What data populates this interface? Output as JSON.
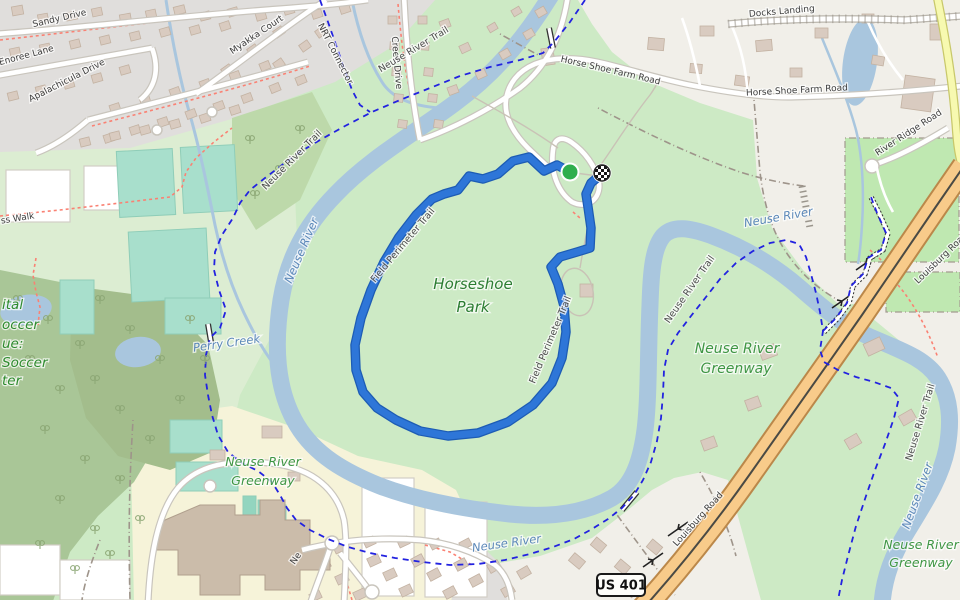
{
  "map": {
    "type": "openstreetmap-with-gps-activity",
    "colors": {
      "park_green": "#cdeac5",
      "grass_green": "#bfe8b1",
      "forest_green": "#a9c697",
      "residential_gray": "#e0dedc",
      "land_beige": "#f1efe9",
      "school_yellow": "#f6f3d9",
      "pitch_teal": "#a8dfcc",
      "water": "#a9c6de",
      "primary_road": "#f8cb8a",
      "secondary_road": "#f7f9b0",
      "cycleway_dash": "#2222e0",
      "footway_dash": "#fa8173",
      "gps_route": "#2e76d8",
      "start_marker": "#2fae4d"
    },
    "route": {
      "name": "gps-activity-route",
      "color": "#2e76d8",
      "outline": "#1d5cb4",
      "points": [
        [
          570,
          172
        ],
        [
          557,
          165
        ],
        [
          544,
          171
        ],
        [
          529,
          157
        ],
        [
          513,
          161
        ],
        [
          498,
          174
        ],
        [
          483,
          179
        ],
        [
          469,
          176
        ],
        [
          458,
          190
        ],
        [
          444,
          194
        ],
        [
          432,
          199
        ],
        [
          416,
          215
        ],
        [
          399,
          237
        ],
        [
          384,
          262
        ],
        [
          371,
          290
        ],
        [
          361,
          318
        ],
        [
          355,
          345
        ],
        [
          356,
          370
        ],
        [
          363,
          392
        ],
        [
          377,
          408
        ],
        [
          396,
          420
        ],
        [
          420,
          431
        ],
        [
          448,
          436
        ],
        [
          478,
          433
        ],
        [
          508,
          422
        ],
        [
          533,
          405
        ],
        [
          552,
          383
        ],
        [
          562,
          358
        ],
        [
          566,
          332
        ],
        [
          564,
          306
        ],
        [
          558,
          284
        ],
        [
          551,
          267
        ],
        [
          560,
          257
        ],
        [
          577,
          252
        ],
        [
          590,
          248
        ],
        [
          591,
          228
        ],
        [
          588,
          207
        ],
        [
          586,
          194
        ],
        [
          591,
          183
        ],
        [
          598,
          177
        ],
        [
          602,
          174
        ]
      ]
    },
    "markers": {
      "start": {
        "x": 570,
        "y": 172,
        "color": "#2fae4d"
      },
      "finish": {
        "x": 602,
        "y": 173,
        "style": "checkered-flag"
      }
    },
    "shield": {
      "text": "US 401",
      "x": 621,
      "y": 585
    },
    "labels": [
      {
        "id": "sandy-drive",
        "text": "Sandy Drive",
        "x": 60,
        "y": 21,
        "rot": -13,
        "cls": "street"
      },
      {
        "id": "creek-drive",
        "text": "Creek Drive",
        "x": 394,
        "y": 63,
        "rot": 85,
        "cls": "street"
      },
      {
        "id": "myakka-court",
        "text": "Myakka Court",
        "x": 258,
        "y": 37,
        "rot": -34,
        "cls": "street"
      },
      {
        "id": "enoree-lane",
        "text": "Enoree Lane",
        "x": 27,
        "y": 58,
        "rot": -15,
        "cls": "street"
      },
      {
        "id": "apalachicula-drive",
        "text": "Apalachicula Drive",
        "x": 68,
        "y": 83,
        "rot": -27,
        "cls": "street"
      },
      {
        "id": "nrt-connector",
        "text": "NRT Connector",
        "x": 333,
        "y": 55,
        "rot": 63,
        "cls": "street"
      },
      {
        "id": "horse-shoe-farm-road-1",
        "text": "Horse Shoe Farm Road",
        "x": 610,
        "y": 73,
        "rot": 13,
        "cls": "street"
      },
      {
        "id": "horse-shoe-farm-road-2",
        "text": "Horse Shoe Farm Road",
        "x": 797,
        "y": 93,
        "rot": -3,
        "cls": "street"
      },
      {
        "id": "docks-landing",
        "text": "Docks Landing",
        "x": 782,
        "y": 14,
        "rot": -5,
        "cls": "street"
      },
      {
        "id": "river-ridge-road",
        "text": "River Ridge Road",
        "x": 910,
        "y": 135,
        "rot": -33,
        "cls": "street"
      },
      {
        "id": "louisburg-road-1",
        "text": "Louisburg Road",
        "x": 700,
        "y": 521,
        "rot": -48,
        "cls": "street"
      },
      {
        "id": "louisburg-road-2",
        "text": "Louisburg Road",
        "x": 943,
        "y": 260,
        "rot": -44,
        "cls": "street"
      },
      {
        "id": "ne-street",
        "text": "Ne",
        "x": 298,
        "y": 560,
        "rot": -55,
        "cls": "street"
      },
      {
        "id": "ss-walk",
        "text": "ss Walk",
        "x": 18,
        "y": 221,
        "rot": -9,
        "cls": "street"
      },
      {
        "id": "neuse-river-trail-1",
        "text": "Neuse River Trail",
        "x": 415,
        "y": 52,
        "rot": -31,
        "cls": "trail"
      },
      {
        "id": "neuse-river-trail-2",
        "text": "Neuse River Trail",
        "x": 294,
        "y": 162,
        "rot": -45,
        "cls": "trail"
      },
      {
        "id": "neuse-river-trail-3",
        "text": "Neuse River Trail",
        "x": 692,
        "y": 291,
        "rot": -55,
        "cls": "trail"
      },
      {
        "id": "neuse-river-trail-4",
        "text": "Neuse River Trail",
        "x": 923,
        "y": 423,
        "rot": -73,
        "cls": "trail"
      },
      {
        "id": "field-perimeter-trail-1",
        "text": "Field Perimeter Trail",
        "x": 405,
        "y": 247,
        "rot": -50,
        "cls": "trail"
      },
      {
        "id": "field-perimeter-trail-2",
        "text": "Field Perimeter Trail",
        "x": 553,
        "y": 341,
        "rot": -67,
        "cls": "trail"
      },
      {
        "id": "neuse-river-1",
        "text": "Neuse River",
        "x": 779,
        "y": 221,
        "rot": -10,
        "cls": "water"
      },
      {
        "id": "neuse-river-2",
        "text": "Neuse River",
        "x": 507,
        "y": 547,
        "rot": -8,
        "cls": "water"
      },
      {
        "id": "neuse-river-3",
        "text": "Neuse River",
        "x": 921,
        "y": 497,
        "rot": -70,
        "cls": "water"
      },
      {
        "id": "neuse-river-4",
        "text": "Neuse River",
        "x": 305,
        "y": 252,
        "rot": -67,
        "cls": "water"
      },
      {
        "id": "perry-creek",
        "text": "Perry Creek",
        "x": 227,
        "y": 347,
        "rot": -8,
        "cls": "water"
      },
      {
        "id": "horseshoe-park-line1",
        "text": "Horseshoe",
        "x": 473,
        "y": 289,
        "rot": 0,
        "cls": "park"
      },
      {
        "id": "horseshoe-park-line2",
        "text": "Park",
        "x": 473,
        "y": 312,
        "rot": 0,
        "cls": "park"
      },
      {
        "id": "greenway-sw-line1",
        "text": "Neuse River",
        "x": 263,
        "y": 466,
        "rot": 0,
        "cls": "greenway"
      },
      {
        "id": "greenway-sw-line2",
        "text": "Greenway",
        "x": 263,
        "y": 485,
        "rot": 0,
        "cls": "greenway"
      },
      {
        "id": "greenway-e-line1",
        "text": "Neuse River",
        "x": 737,
        "y": 353,
        "rot": 0,
        "cls": "greenwaylg"
      },
      {
        "id": "greenway-e-line2",
        "text": "Greenway",
        "x": 736,
        "y": 373,
        "rot": 0,
        "cls": "greenwaylg"
      },
      {
        "id": "greenway-se-line1",
        "text": "Neuse River",
        "x": 921,
        "y": 549,
        "rot": 0,
        "cls": "greenway"
      },
      {
        "id": "greenway-se-line2",
        "text": "Greenway",
        "x": 921,
        "y": 567,
        "rot": 0,
        "cls": "greenway"
      },
      {
        "id": "soccer-frag-1",
        "text": "ital",
        "x": 2,
        "y": 309,
        "rot": 0,
        "cls": "sports"
      },
      {
        "id": "soccer-frag-2",
        "text": "occer",
        "x": 2,
        "y": 329,
        "rot": 0,
        "cls": "sports"
      },
      {
        "id": "soccer-frag-3",
        "text": "ue:",
        "x": 2,
        "y": 348,
        "rot": 0,
        "cls": "sports"
      },
      {
        "id": "soccer-frag-4",
        "text": "Soccer",
        "x": 2,
        "y": 367,
        "rot": 0,
        "cls": "sports"
      },
      {
        "id": "soccer-frag-5",
        "text": "ter",
        "x": 2,
        "y": 385,
        "rot": 0,
        "cls": "sports"
      }
    ]
  }
}
